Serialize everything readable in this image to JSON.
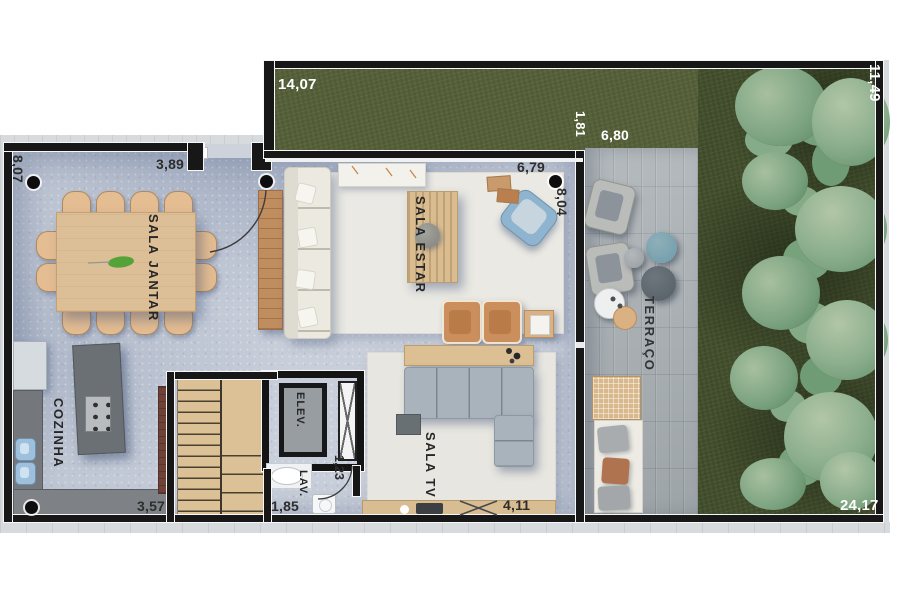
{
  "rooms": {
    "sala_jantar": "SALA JANTAR",
    "sala_estar": "SALA ESTAR",
    "cozinha": "COZINHA",
    "sala_tv": "SALA TV",
    "elevador": "ELEV.",
    "lavabo": "LAV.",
    "terraco": "TERRAÇO"
  },
  "dimensions": {
    "garden_top": "14,07",
    "garden_right": "11,49",
    "garden_strip": "1,81",
    "deck_width": "6,80",
    "sala_estar_width": "6,79",
    "sala_estar_depth": "8,04",
    "sala_jantar_depth": "8,07",
    "sala_jantar_width": "3,89",
    "cozinha_width": "3,57",
    "lavabo_width": "1,85",
    "lavabo_depth": "1,23",
    "sala_tv_width": "4,11",
    "lot_width": "24,17"
  },
  "colors": {
    "grass": "#4d5a34",
    "foliage": "#7ea383",
    "deck": "#a7aeb2",
    "floor": "#c9cfda",
    "wall": "#171717",
    "wood": "#dcbf97",
    "counter": "#6e7276",
    "sofa": "#ece9e0",
    "sectional": "#a8b2bb",
    "armchair_tan": "#c9905c",
    "armchair_blue": "#8fb4cf",
    "rug": "#e9e8e2"
  }
}
